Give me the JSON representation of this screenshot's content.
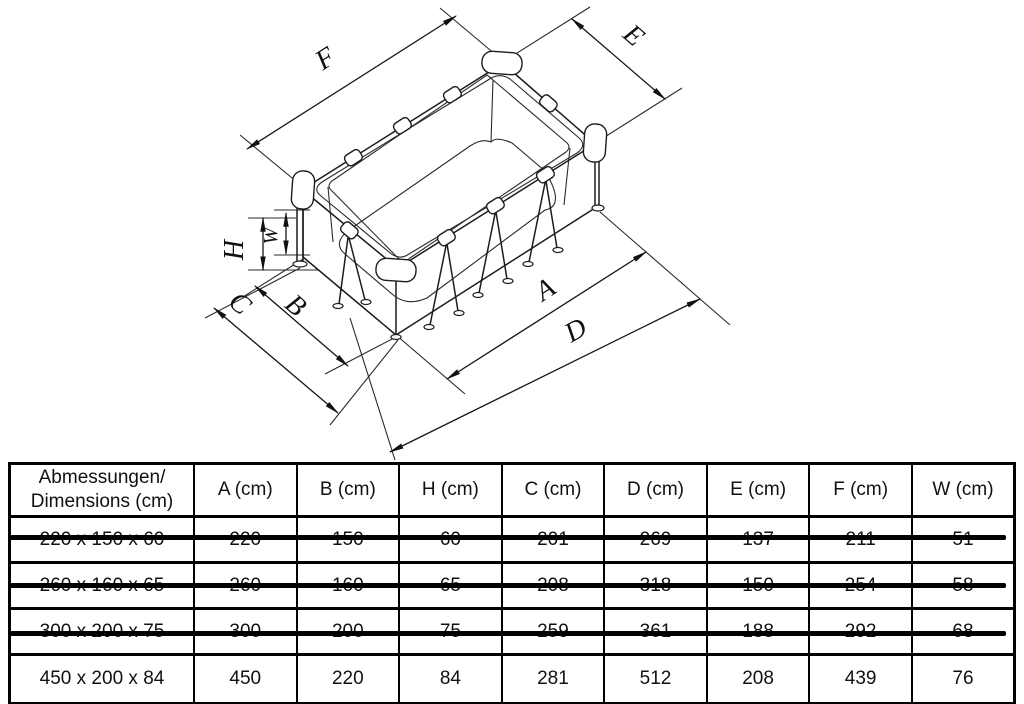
{
  "diagram": {
    "description": "isometric line drawing of rectangular frame pool with dimension arrows",
    "labels": {
      "F": "F",
      "E": "E",
      "H": "H",
      "W": "W",
      "C": "C",
      "B": "B",
      "A": "A",
      "D": "D"
    }
  },
  "table": {
    "header": {
      "col0_line1": "Abmessungen/",
      "col0_line2": "Dimensions (cm)",
      "columns": [
        "A (cm)",
        "B (cm)",
        "H (cm)",
        "C (cm)",
        "D (cm)",
        "E (cm)",
        "F (cm)",
        "W (cm)"
      ]
    },
    "rows": [
      {
        "label": "220 x 150 x 60",
        "values": [
          "220",
          "150",
          "60",
          "201",
          "269",
          "137",
          "211",
          "51"
        ],
        "struck": true
      },
      {
        "label": "260 x 160 x 65",
        "values": [
          "260",
          "160",
          "65",
          "208",
          "318",
          "150",
          "254",
          "58"
        ],
        "struck": true
      },
      {
        "label": "300 x 200 x 75",
        "values": [
          "300",
          "200",
          "75",
          "259",
          "361",
          "188",
          "292",
          "68"
        ],
        "struck": true
      },
      {
        "label": "450 x 200 x 84",
        "values": [
          "450",
          "220",
          "84",
          "281",
          "512",
          "208",
          "439",
          "76"
        ],
        "struck": false
      }
    ]
  },
  "colors": {
    "line": "#1c1c1c",
    "background": "#ffffff",
    "strike": "#000000"
  }
}
